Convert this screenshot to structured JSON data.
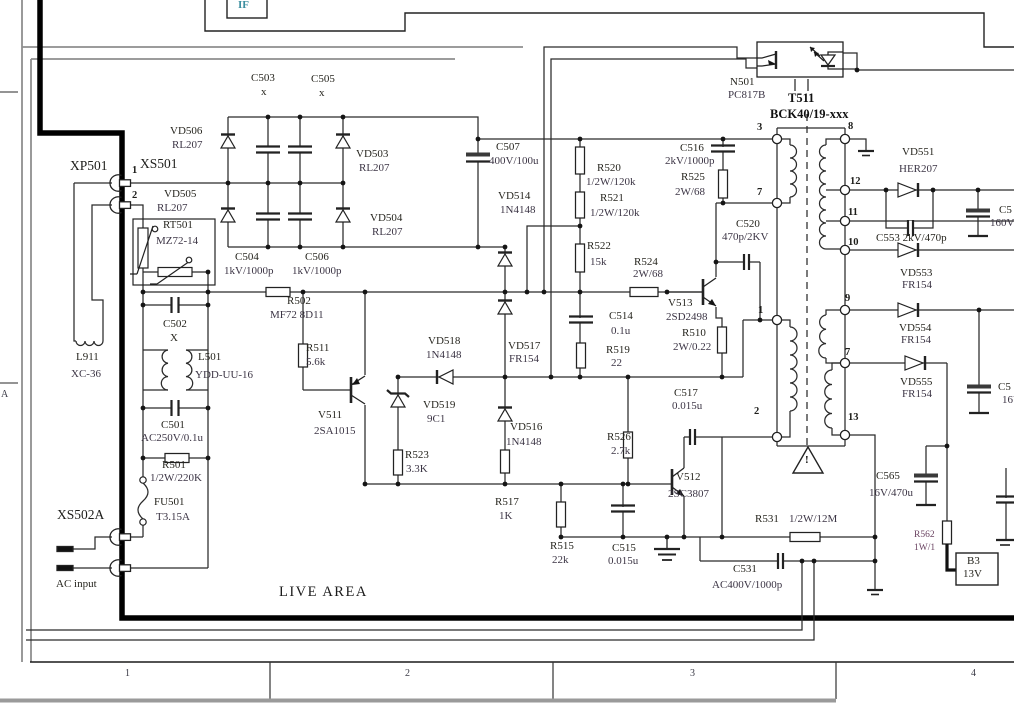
{
  "labels": {
    "if_block": "IF",
    "n501": "N501",
    "n501_v": "PC817B",
    "t511": "T511",
    "t511_v": "BCK40/19-xxx",
    "xp501": "XP501",
    "xs501": "XS501",
    "xs501_p1": "1",
    "xs501_p2": "2",
    "vd506": "VD506",
    "vd506_v": "RL207",
    "vd505": "VD505",
    "vd505_v": "RL207",
    "vd503": "VD503",
    "vd503_v": "RL207",
    "vd504": "VD504",
    "vd504_v": "RL207",
    "c503": "C503",
    "c503_v": "x",
    "c505": "C505",
    "c505_v": "x",
    "c504": "C504",
    "c504_v": "1kV/1000p",
    "c506": "C506",
    "c506_v": "1kV/1000p",
    "rt501": "RT501",
    "rt501_v": "MZ72-14",
    "r502": "R502",
    "r502_v": "MF72 8D11",
    "c502": "C502",
    "c502_v": "X",
    "l911": "L911",
    "l911_v": "XC-36",
    "l501": "L501",
    "l501_v": "YDD-UU-16",
    "c501": "C501",
    "c501_v": "AC250V/0.1u",
    "r501": "R501",
    "r501_v": "1/2W/220K",
    "fu501": "FU501",
    "fu501_v": "T3.15A",
    "xs502a": "XS502A",
    "ac_input": "AC input",
    "live_area": "LIVE AREA",
    "zone_a": "A",
    "r511": "R511",
    "r511_v": "5.6k",
    "v511": "V511",
    "v511_v": "2SA1015",
    "vd518": "VD518",
    "vd518_v": "1N4148",
    "vd519": "VD519",
    "vd519_v": "9C1",
    "r523": "R523",
    "r523_v": "3.3K",
    "vd517": "VD517",
    "vd517_v": "FR154",
    "vd516": "VD516",
    "vd516_v": "1N4148",
    "r517": "R517",
    "r517_v": "1K",
    "r515": "R515",
    "r515_v": "22k",
    "c515": "C515",
    "c515_v": "0.015u",
    "c507": "C507",
    "c507_v": "400V/100u",
    "vd514": "VD514",
    "vd514_v": "1N4148",
    "r520": "R520",
    "r520_v": "1/2W/120k",
    "r521": "R521",
    "r521_v": "1/2W/120k",
    "r522": "R522",
    "r522_v": "15k",
    "r524": "R524",
    "r524_v": "2W/68",
    "c514": "C514",
    "c514_v": "0.1u",
    "r519": "R519",
    "r519_v": "22",
    "r526": "R526",
    "r526_v": "2.7k",
    "c516": "C516",
    "c516_v": "2kV/1000p",
    "r525": "R525",
    "r525_v": "2W/68",
    "c520": "C520",
    "c520_v": "470p/2KV",
    "v513": "V513",
    "v513_v": "2SD2498",
    "r510": "R510",
    "r510_v": "2W/0.22",
    "c517": "C517",
    "c517_v": "0.015u",
    "v512": "V512",
    "v512_v": "2SC3807",
    "r531": "R531",
    "r531_v": "1/2W/12M",
    "c531": "C531",
    "c531_v": "AC400V/1000p",
    "r562": "R562",
    "r562_v": "1W/1",
    "b3": "B3",
    "b3_v": "13V",
    "c565": "C565",
    "c565_v": "16V/470u",
    "c553": "C553 2kV/470p",
    "vd551": "VD551",
    "vd551_v": "HER207",
    "vd553": "VD553",
    "vd553_v": "FR154",
    "vd554": "VD554",
    "vd554_v": "FR154",
    "vd555": "VD555",
    "vd555_v": "FR154",
    "ccut1": "C5",
    "ccut1_v": "160V",
    "ccut2": "C5",
    "ccut2_v": "16V",
    "warn": "!"
  },
  "pins": {
    "l3": "3",
    "l7": "7",
    "l1": "1",
    "l2": "2",
    "r8": "8",
    "r12": "12",
    "r11": "11",
    "r10": "10",
    "r9": "9",
    "r7": "7",
    "r13": "13"
  },
  "footer": {
    "c1": "1",
    "c2": "2",
    "c3": "3",
    "c4": "4"
  }
}
